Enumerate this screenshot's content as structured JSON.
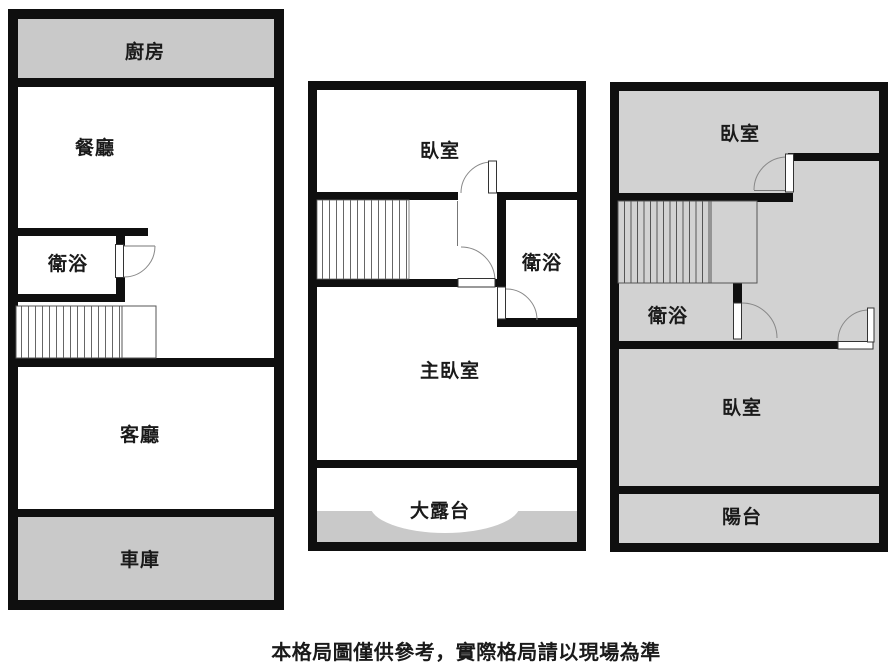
{
  "floors": {
    "f1": {
      "kitchen": "廚房",
      "dining": "餐廳",
      "bath": "衛浴",
      "living": "客廳",
      "garage": "車庫"
    },
    "f2": {
      "bedroom": "臥室",
      "bath": "衛浴",
      "master": "主臥室",
      "terrace": "大露台"
    },
    "f3": {
      "bedroom_top": "臥室",
      "bath": "衛浴",
      "bedroom_mid": "臥室",
      "balcony": "陽台"
    }
  },
  "disclaimer": "本格局圖僅供參考，實際格局請以現場為準",
  "colors": {
    "wall": "#0f0f0f",
    "gray_fill": "#c9c9c9",
    "floor3_fill": "#d2d2d2",
    "room_fill": "#ffffff"
  }
}
